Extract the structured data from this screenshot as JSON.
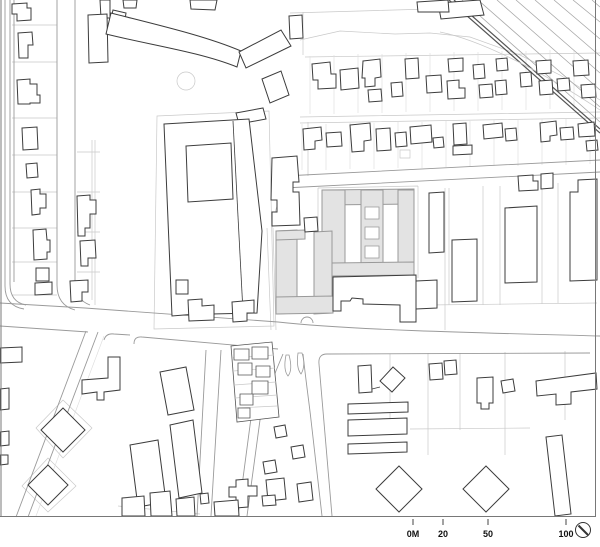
{
  "map": {
    "kind": "architectural-site-plan",
    "background_color": "#ffffff",
    "building_outline_color": "#3c3c3c",
    "parcel_line_color": "#c9c9c9",
    "road_line_color": "#9a9a9a",
    "railway_line_color": "#555555",
    "frame_color": "#787878",
    "highlight": {
      "fill": "#e3e3e3",
      "outline": "#999999"
    }
  },
  "scale_bar": {
    "labels": [
      "0M",
      "20",
      "50",
      "100"
    ],
    "values_m": [
      0,
      20,
      50,
      100
    ]
  },
  "north_arrow": {
    "icon": "north-arrow-icon"
  }
}
